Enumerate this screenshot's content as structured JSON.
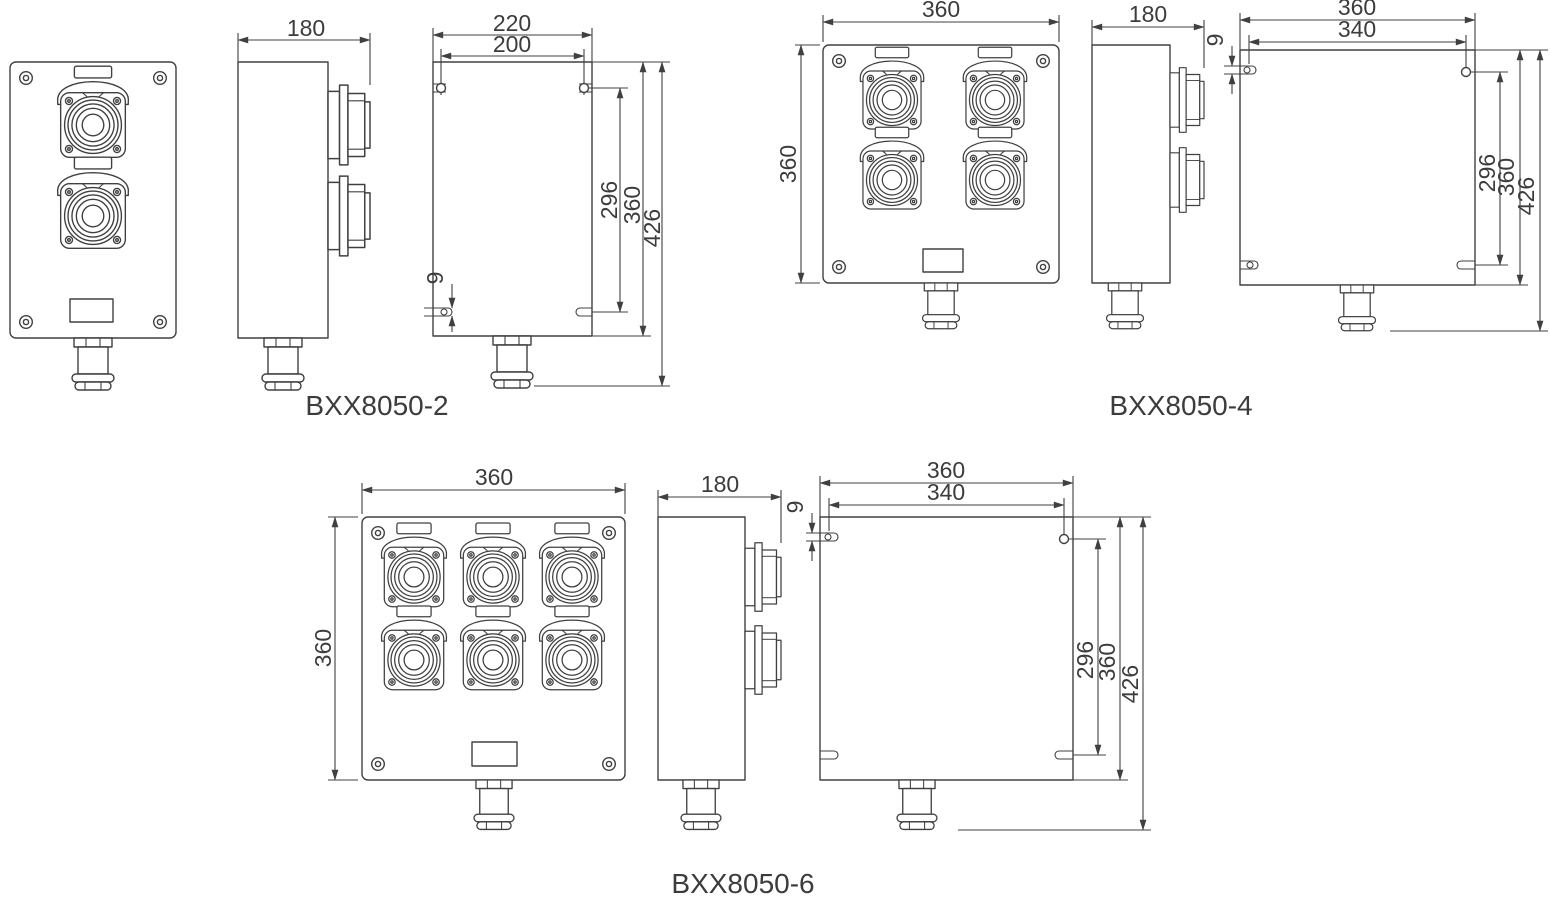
{
  "style": {
    "background": "#ffffff",
    "line_color": "#404040",
    "text_color": "#3c3c3c"
  },
  "drawing_type": "dimensional engineering drawing",
  "models": [
    {
      "id": "bxx8050-2",
      "caption": "BXX8050-2",
      "socket_count": 2,
      "dims": {
        "depth": "180",
        "rear_width": "220",
        "rear_hole_spacing": "200",
        "slot_width": "9",
        "hole_span": "296",
        "body_height": "360",
        "total_height": "426"
      }
    },
    {
      "id": "bxx8050-4",
      "caption": "BXX8050-4",
      "socket_count": 4,
      "dims": {
        "front_width": "360",
        "front_height": "360",
        "depth": "180",
        "rear_width": "360",
        "rear_hole_spacing": "340",
        "slot_width": "9",
        "hole_span": "296",
        "body_height": "360",
        "total_height": "426"
      }
    },
    {
      "id": "bxx8050-6",
      "caption": "BXX8050-6",
      "socket_count": 6,
      "dims": {
        "front_width": "360",
        "front_height": "360",
        "depth": "180",
        "rear_width": "360",
        "rear_hole_spacing": "340",
        "slot_width": "9",
        "hole_span": "296",
        "body_height": "360",
        "total_height": "426"
      }
    }
  ]
}
